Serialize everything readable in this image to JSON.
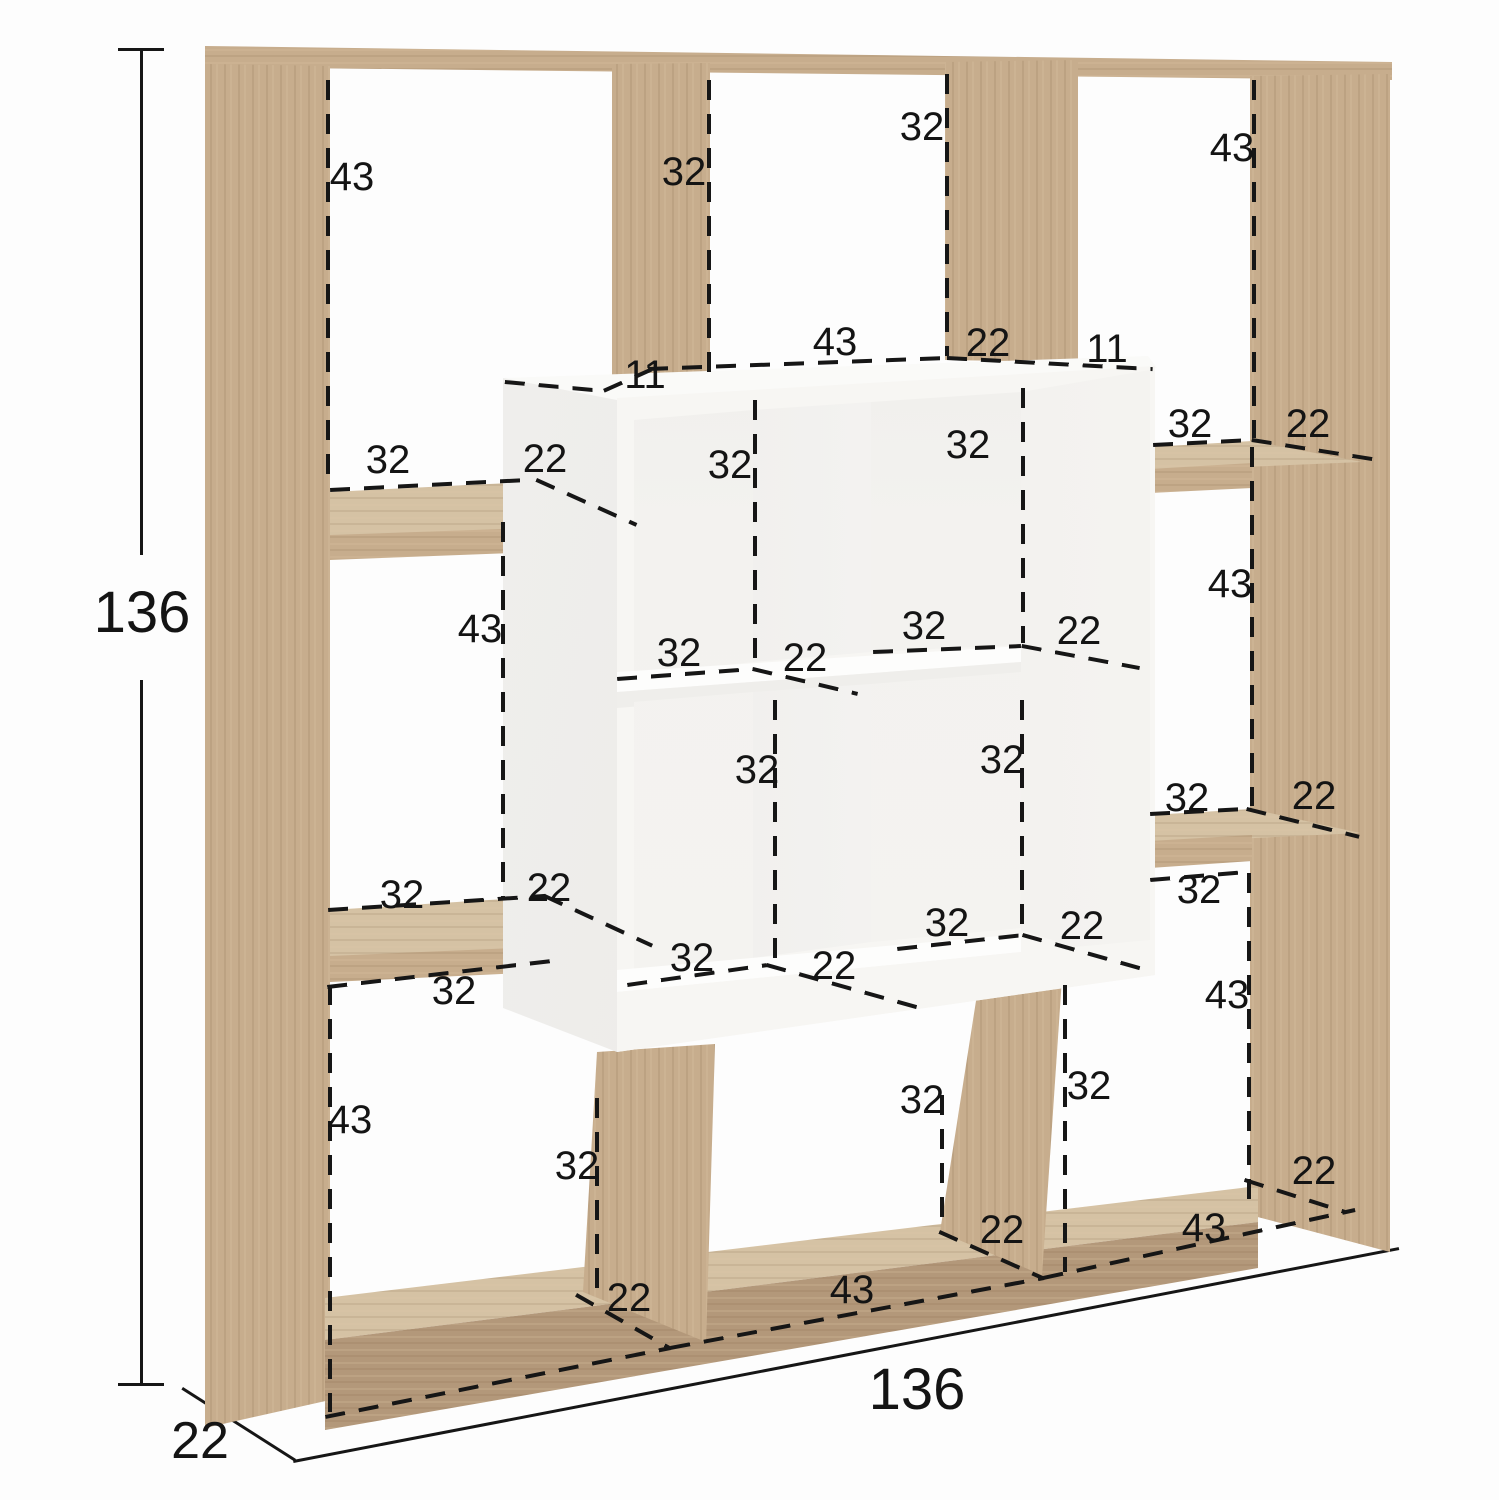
{
  "diagram_type": "furniture-dimension-diagram",
  "subject": "cube bookshelf with oak outer frame and white center cube unit",
  "colors": {
    "background": "#fdfdfd",
    "wood": "#c7ad8d",
    "wood_light": "#d5c2a4",
    "wood_dark": "#b3987a",
    "white_unit": "#f7f6f3",
    "dash": "#161616",
    "text": "#141414"
  },
  "overall_dimensions": {
    "height": "136",
    "width": "136",
    "depth": "22"
  },
  "dimension_labels": [
    {
      "t": "136",
      "x": 142,
      "y": 613,
      "fs": 58,
      "n": "overall-height"
    },
    {
      "t": "136",
      "x": 917,
      "y": 1390,
      "fs": 58,
      "n": "overall-width"
    },
    {
      "t": "22",
      "x": 200,
      "y": 1441,
      "fs": 52,
      "n": "overall-depth"
    },
    {
      "t": "43",
      "x": 352,
      "y": 177
    },
    {
      "t": "32",
      "x": 684,
      "y": 172
    },
    {
      "t": "32",
      "x": 922,
      "y": 127
    },
    {
      "t": "43",
      "x": 1232,
      "y": 148
    },
    {
      "t": "43",
      "x": 835,
      "y": 342
    },
    {
      "t": "22",
      "x": 988,
      "y": 343
    },
    {
      "t": "11",
      "x": 645,
      "y": 375
    },
    {
      "t": "11",
      "x": 1107,
      "y": 349
    },
    {
      "t": "32",
      "x": 388,
      "y": 460
    },
    {
      "t": "22",
      "x": 545,
      "y": 459
    },
    {
      "t": "32",
      "x": 730,
      "y": 465
    },
    {
      "t": "32",
      "x": 968,
      "y": 445
    },
    {
      "t": "32",
      "x": 1190,
      "y": 424
    },
    {
      "t": "22",
      "x": 1308,
      "y": 424
    },
    {
      "t": "43",
      "x": 480,
      "y": 629
    },
    {
      "t": "43",
      "x": 1230,
      "y": 584
    },
    {
      "t": "32",
      "x": 679,
      "y": 653
    },
    {
      "t": "22",
      "x": 805,
      "y": 658
    },
    {
      "t": "32",
      "x": 924,
      "y": 626
    },
    {
      "t": "22",
      "x": 1079,
      "y": 631
    },
    {
      "t": "32",
      "x": 757,
      "y": 770
    },
    {
      "t": "32",
      "x": 1002,
      "y": 760
    },
    {
      "t": "32",
      "x": 1187,
      "y": 798
    },
    {
      "t": "22",
      "x": 1314,
      "y": 796
    },
    {
      "t": "32",
      "x": 402,
      "y": 895
    },
    {
      "t": "22",
      "x": 549,
      "y": 888
    },
    {
      "t": "32",
      "x": 1199,
      "y": 890
    },
    {
      "t": "32",
      "x": 947,
      "y": 923
    },
    {
      "t": "22",
      "x": 1082,
      "y": 926
    },
    {
      "t": "32",
      "x": 692,
      "y": 958
    },
    {
      "t": "22",
      "x": 834,
      "y": 966
    },
    {
      "t": "32",
      "x": 454,
      "y": 991
    },
    {
      "t": "43",
      "x": 1227,
      "y": 995
    },
    {
      "t": "43",
      "x": 350,
      "y": 1120
    },
    {
      "t": "32",
      "x": 577,
      "y": 1166
    },
    {
      "t": "32",
      "x": 922,
      "y": 1100
    },
    {
      "t": "32",
      "x": 1089,
      "y": 1086
    },
    {
      "t": "22",
      "x": 629,
      "y": 1298
    },
    {
      "t": "43",
      "x": 852,
      "y": 1290
    },
    {
      "t": "22",
      "x": 1002,
      "y": 1230
    },
    {
      "t": "43",
      "x": 1204,
      "y": 1228
    },
    {
      "t": "22",
      "x": 1314,
      "y": 1171
    }
  ]
}
